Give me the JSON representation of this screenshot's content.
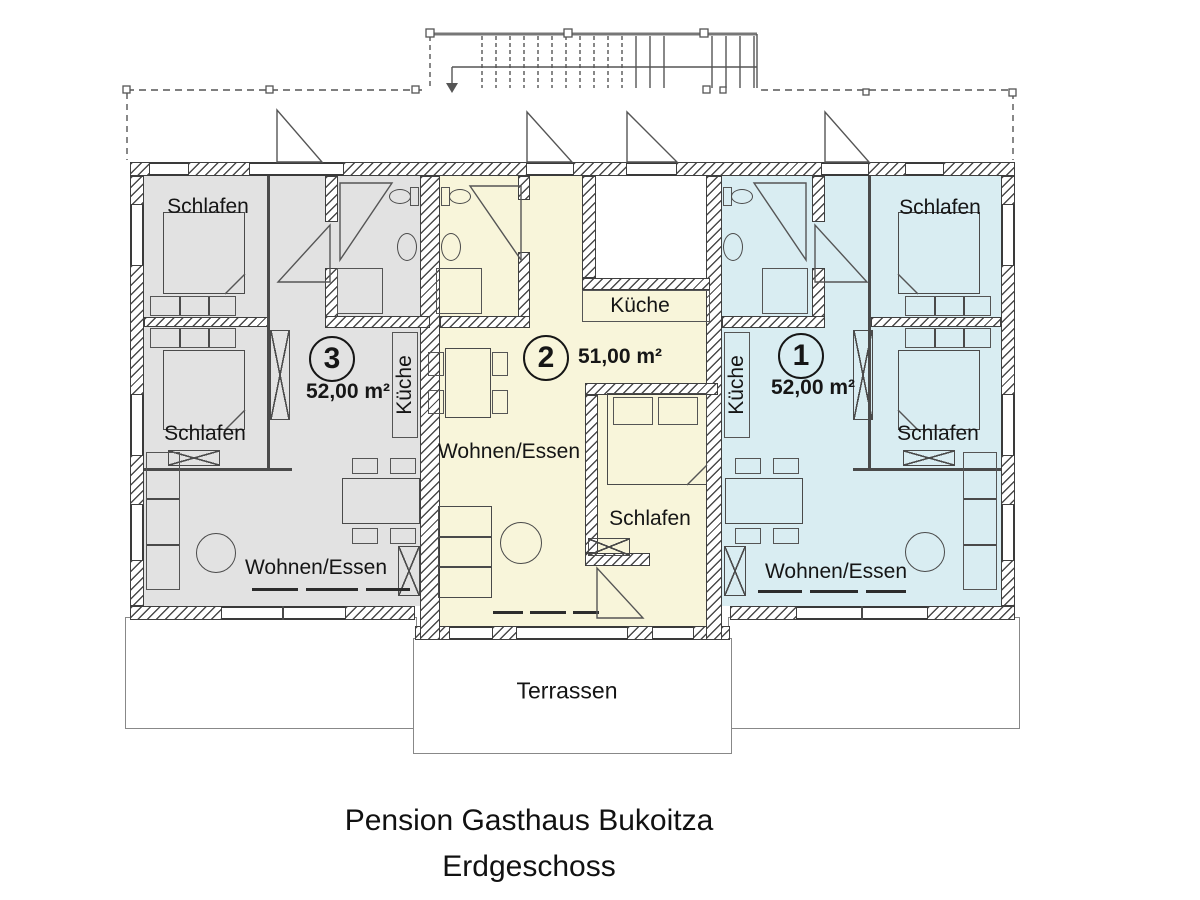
{
  "title": {
    "line1": "Pension Gasthaus Bukoitza",
    "line2": "Erdgeschoss"
  },
  "labels": {
    "schlafen": "Schlafen",
    "kueche": "Küche",
    "wohnen_essen": "Wohnen/Essen",
    "terrassen": "Terrassen"
  },
  "apartments": {
    "a3": {
      "number": "3",
      "area": "52,00 m²",
      "color": "#e2e2e2"
    },
    "a2": {
      "number": "2",
      "area": "51,00 m²",
      "color": "#f8f5da"
    },
    "a1": {
      "number": "1",
      "area": "52,00 m²",
      "color": "#d9edf2"
    }
  }
}
